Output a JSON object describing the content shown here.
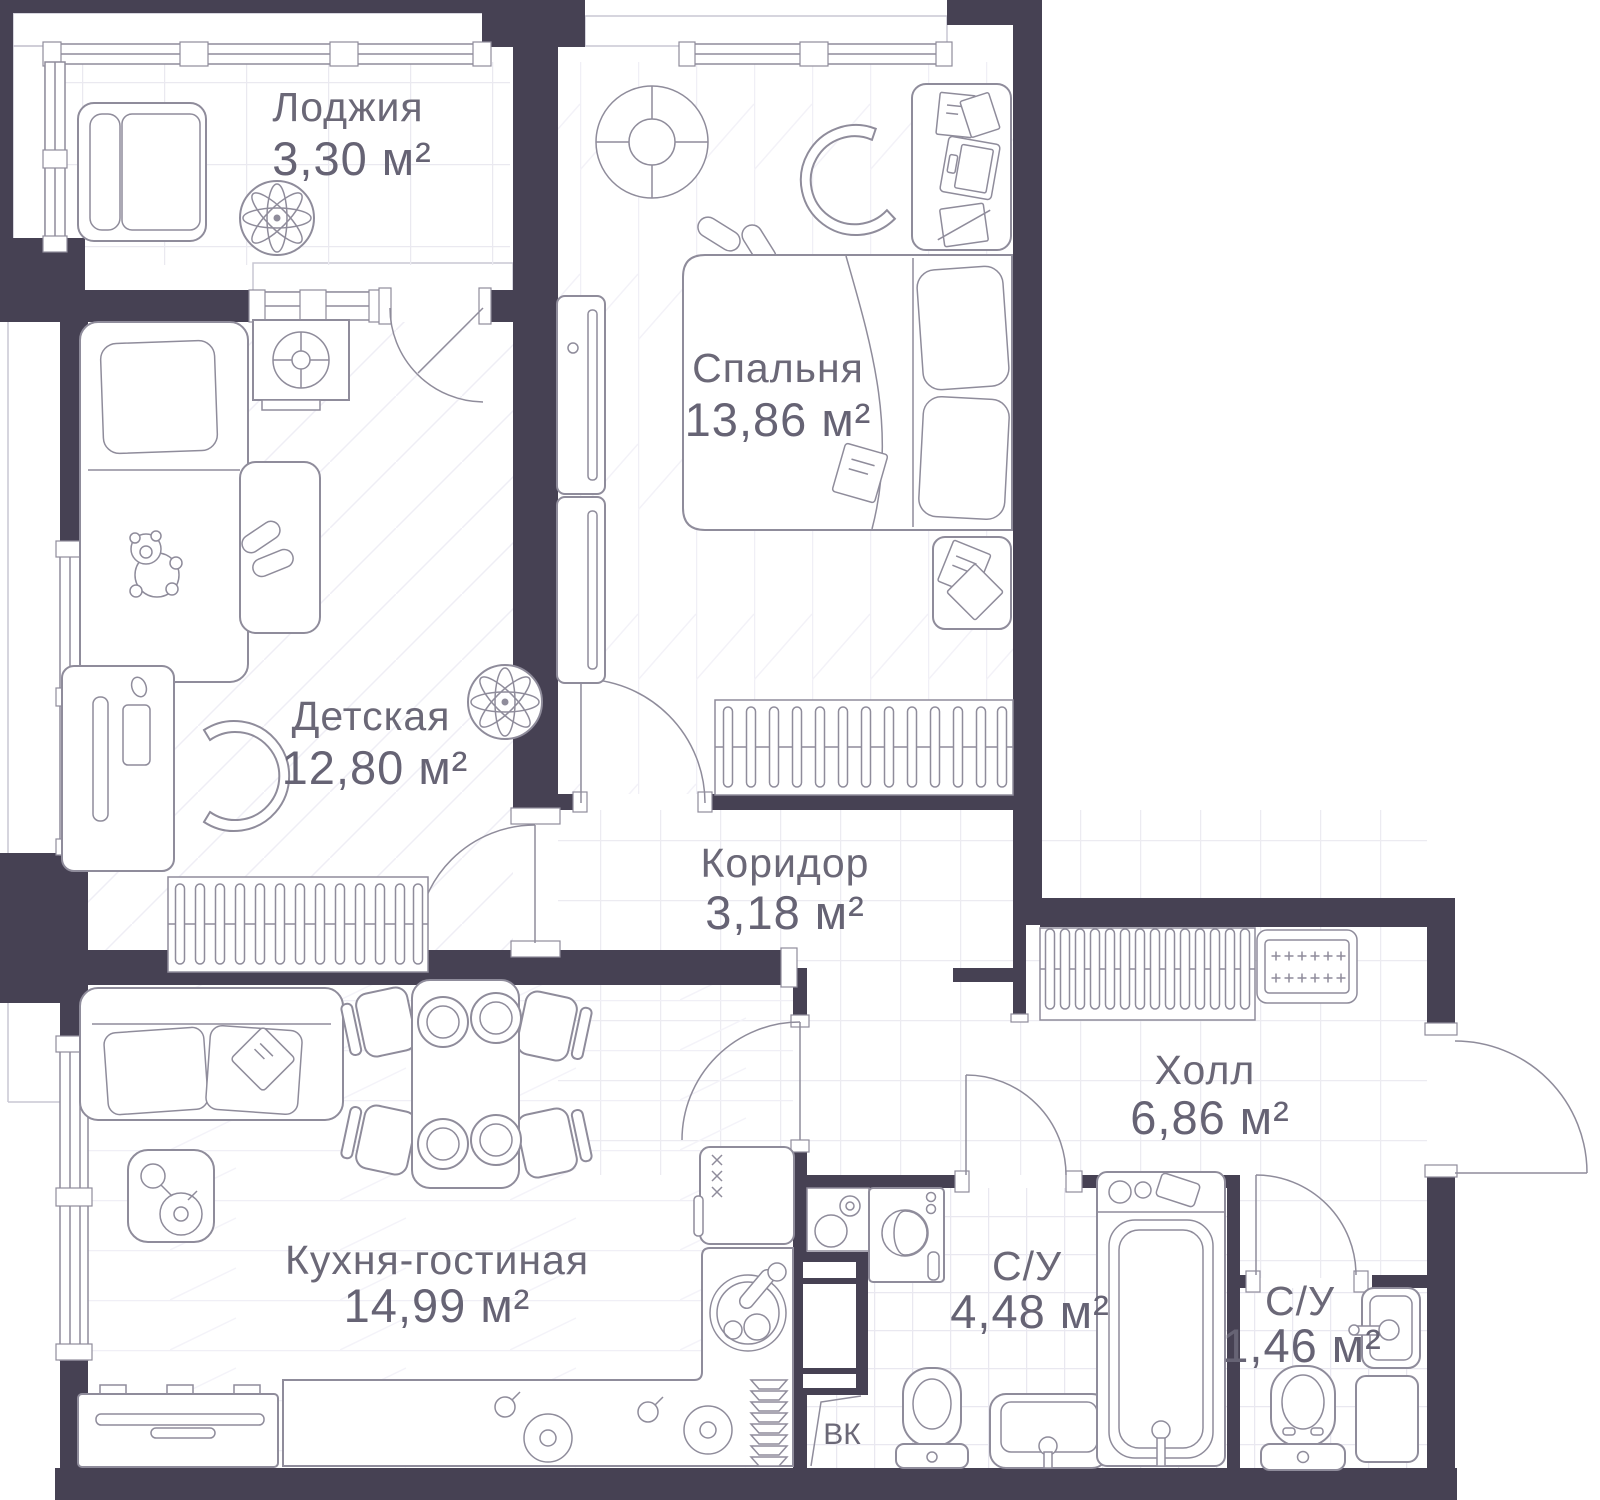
{
  "plan": {
    "type": "apartment-floor-plan",
    "units": "м²",
    "colors": {
      "wall": "#464153",
      "furniture_line": "#8f8c9b",
      "floor": "#ffffff",
      "floor_grid": "#ecebf1",
      "label_text": "#6b6877"
    }
  },
  "rooms": [
    {
      "id": "loggia",
      "name": "Лоджия",
      "area": "3,30 м²"
    },
    {
      "id": "bedroom",
      "name": "Спальня",
      "area": "13,86 м²"
    },
    {
      "id": "children",
      "name": "Детская",
      "area": "12,80 м²"
    },
    {
      "id": "corridor",
      "name": "Коридор",
      "area": "3,18 м²"
    },
    {
      "id": "kitchen-living",
      "name": "Кухня-гостиная",
      "area": "14,99 м²"
    },
    {
      "id": "hall",
      "name": "Холл",
      "area": "6,86 м²"
    },
    {
      "id": "bathroom",
      "name": "С/У",
      "area": "4,48 м²"
    },
    {
      "id": "wc",
      "name": "С/У",
      "area": "1,46 м²"
    }
  ],
  "labels": {
    "duct": "ВК"
  },
  "icons": [
    "armchair-icon",
    "plant-icon",
    "ceiling-light-icon",
    "desk-icon",
    "laptop-icon",
    "office-chair-icon",
    "slippers-icon",
    "bed-icon",
    "nightstand-icon",
    "wardrobe-icon",
    "tv-console-icon",
    "teddy-bear-icon",
    "monitor-icon",
    "keyboard-icon",
    "mouse-icon",
    "sofa-icon",
    "pillow-icon",
    "dining-table-icon",
    "plate-icon",
    "chair-icon",
    "fridge-icon",
    "kitchen-counter-icon",
    "stove-burner-icon",
    "sink-icon",
    "dish-rack-icon",
    "washing-machine-icon",
    "toilet-icon",
    "bathtub-icon",
    "doormat-icon",
    "door-icon",
    "window-icon"
  ]
}
